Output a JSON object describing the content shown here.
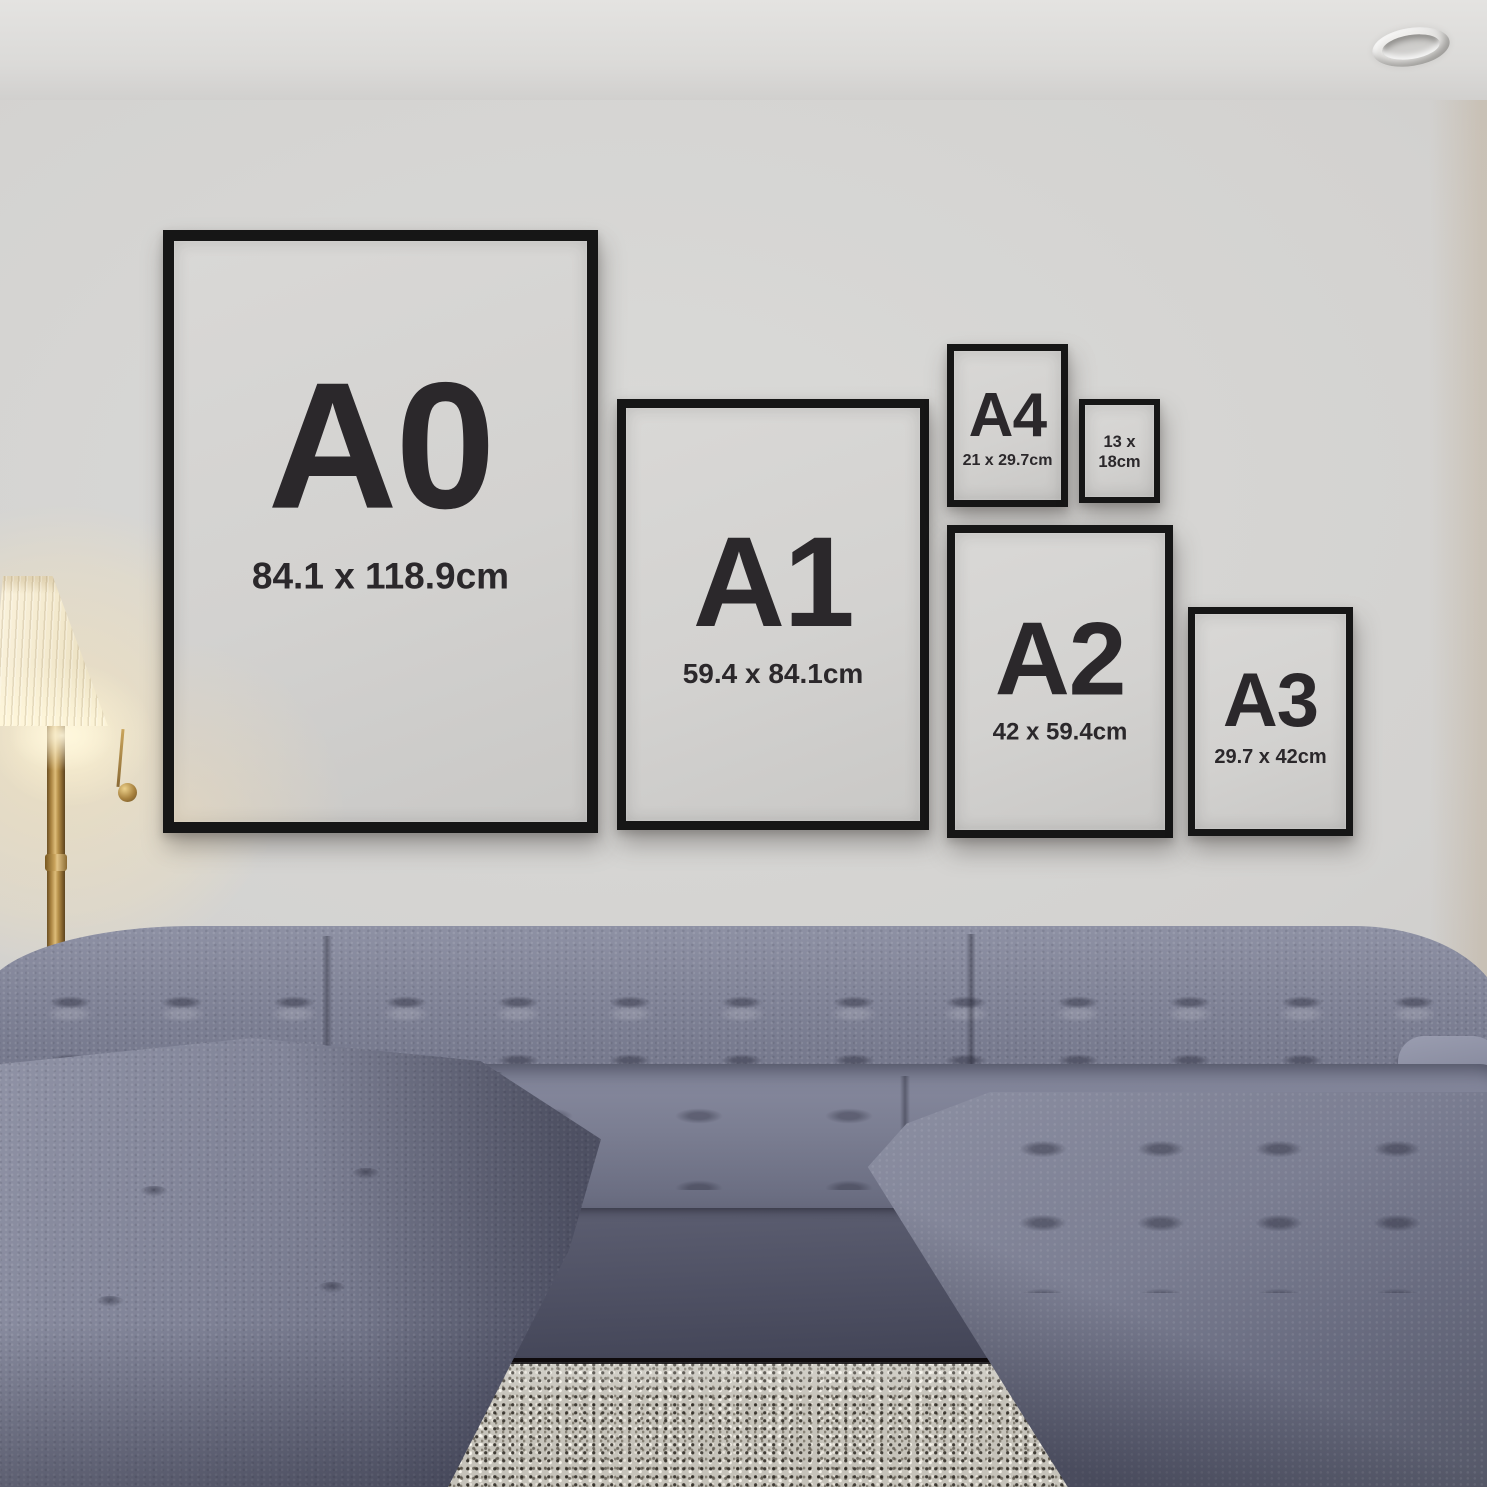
{
  "frames": [
    {
      "id": "a0",
      "label": "A0",
      "dimensions": "84.1 x 118.9cm"
    },
    {
      "id": "a1",
      "label": "A1",
      "dimensions": "59.4 x 84.1cm"
    },
    {
      "id": "a4",
      "label": "A4",
      "dimensions": "21 x 29.7cm"
    },
    {
      "id": "13x18",
      "label": "",
      "dimensions_line1": "13 x",
      "dimensions_line2": "18cm"
    },
    {
      "id": "a2",
      "label": "A2",
      "dimensions": "42 x 59.4cm"
    },
    {
      "id": "a3",
      "label": "A3",
      "dimensions": "29.7 x 42cm"
    }
  ],
  "colors": {
    "frame_black": "#161616",
    "poster_gray": "#d6d5d3",
    "text_dark": "#2b282b",
    "wall_gray": "#d3d2d0",
    "sofa_gray_blue": "#7b7e92",
    "lamp_brass": "#b08c4f",
    "lamp_shade_cream": "#f4ecd8",
    "rug_beige": "#c6c3ba"
  }
}
